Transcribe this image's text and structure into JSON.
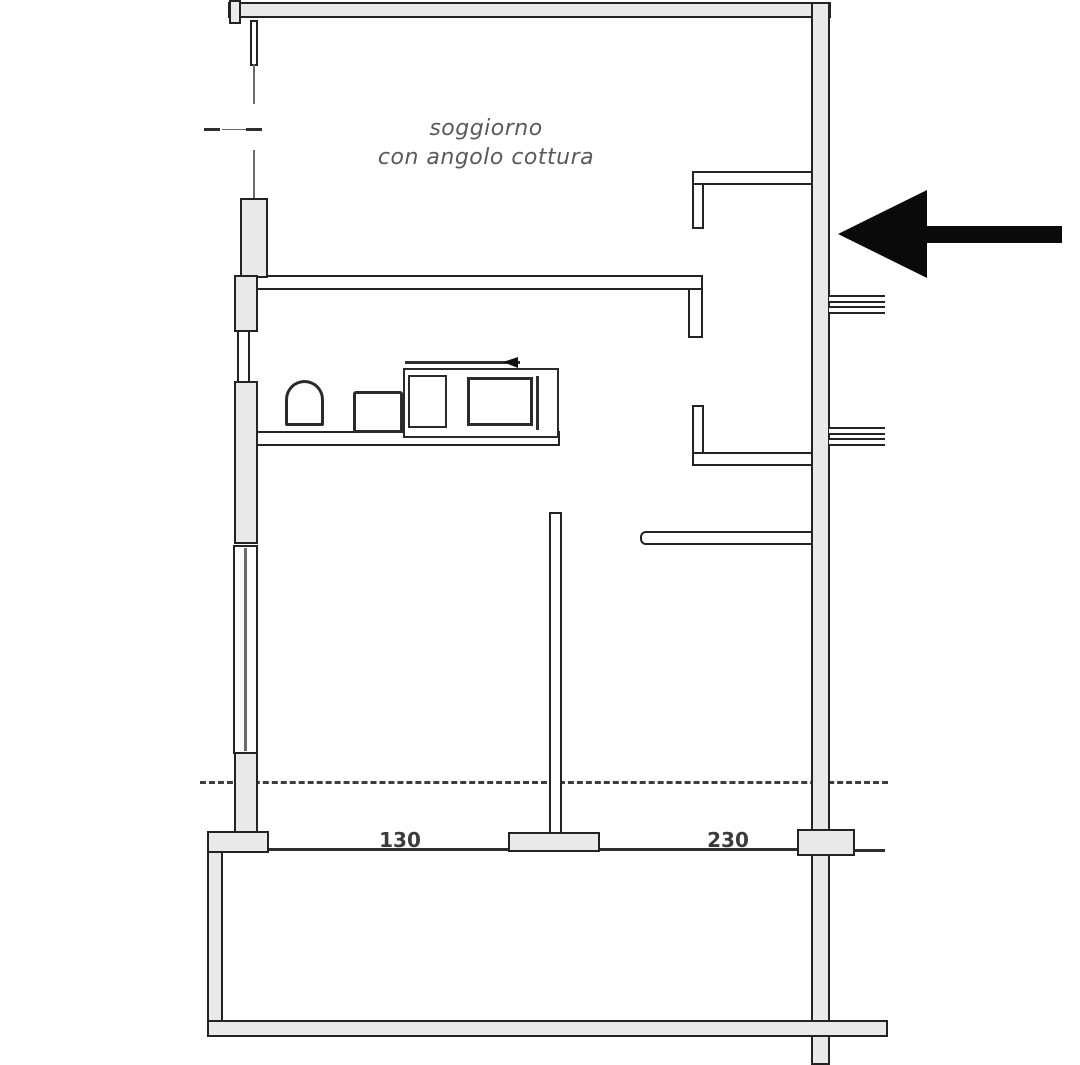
{
  "floorplan": {
    "type": "apartment-floor-plan",
    "room_label": {
      "line1": "soggiorno",
      "line2": "con angolo cottura"
    },
    "dimensions": {
      "balcony_left": "130",
      "balcony_right": "230"
    },
    "annotation": {
      "arrow_direction": "left",
      "arrow_color": "#0a0a0a"
    },
    "colors": {
      "background": "#ffffff",
      "wall_fill": "#e9e9e9",
      "wall_line": "#232323",
      "room_label_text": "#5a5a5a",
      "dimension_text": "#3b3b3b"
    }
  }
}
